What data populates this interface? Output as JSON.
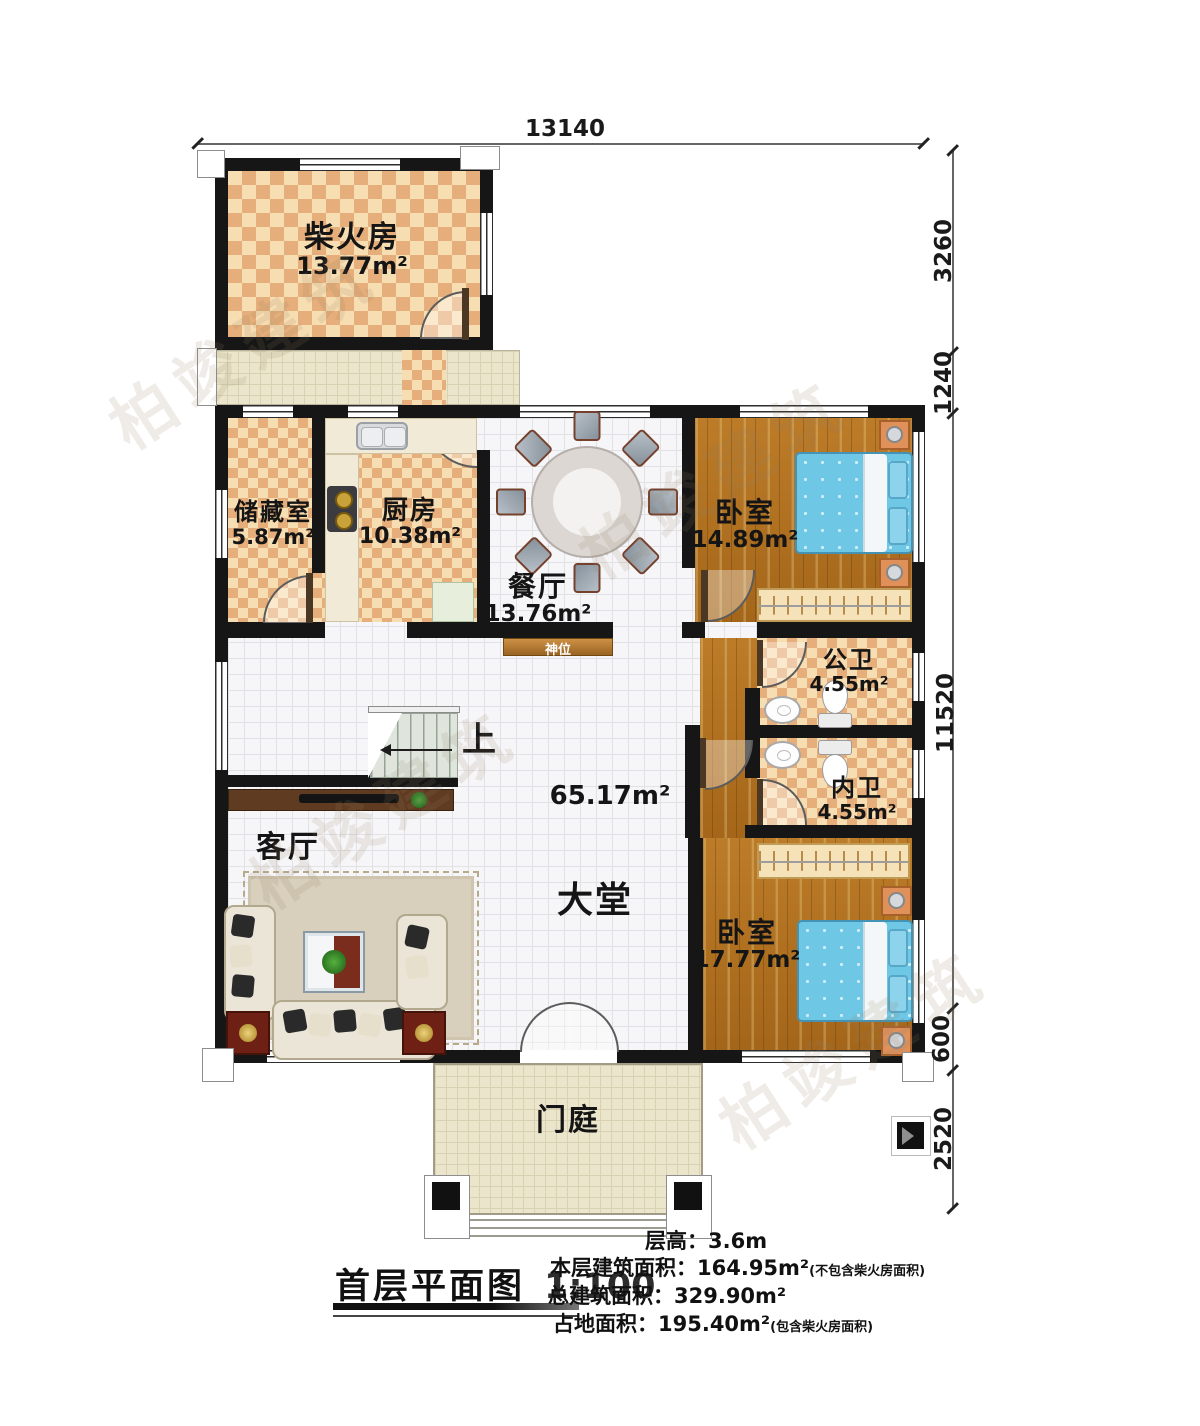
{
  "watermark": {
    "text": "柏竣建筑"
  },
  "dimensions": {
    "top": "13140",
    "right": [
      "3260",
      "1240",
      "11520",
      "600",
      "2520"
    ]
  },
  "rooms": {
    "chaihuofang": {
      "name": "柴火房",
      "area": "13.77m²"
    },
    "chucangshi": {
      "name": "储藏室",
      "area": "5.87m²"
    },
    "chufang": {
      "name": "厨房",
      "area": "10.38m²"
    },
    "canting": {
      "name": "餐厅",
      "area": "13.76m²"
    },
    "woshi_top": {
      "name": "卧室",
      "area": "14.89m²"
    },
    "gongwei": {
      "name": "公卫",
      "area": "4.55m²"
    },
    "neiwei": {
      "name": "内卫",
      "area": "4.55m²"
    },
    "woshi_bottom": {
      "name": "卧室",
      "area": "17.77m²"
    },
    "keting": {
      "name": "客厅"
    },
    "datang": {
      "name": "大堂",
      "area": "65.17m²"
    },
    "menting": {
      "name": "门庭"
    }
  },
  "annotations": {
    "shenwei": "神位",
    "stairs_up": "上"
  },
  "footer": {
    "title": "首层平面图",
    "scale": "1:100",
    "stats": [
      {
        "label": "层高：",
        "value": "3.6m",
        "note": ""
      },
      {
        "label": "本层建筑面积：",
        "value": "164.95m²",
        "note": "(不包含柴火房面积)"
      },
      {
        "label": "总建筑面积：",
        "value": "329.90m²",
        "note": ""
      },
      {
        "label": "占地面积：",
        "value": "195.40m²",
        "note": "(包含柴火房面积)"
      }
    ]
  }
}
